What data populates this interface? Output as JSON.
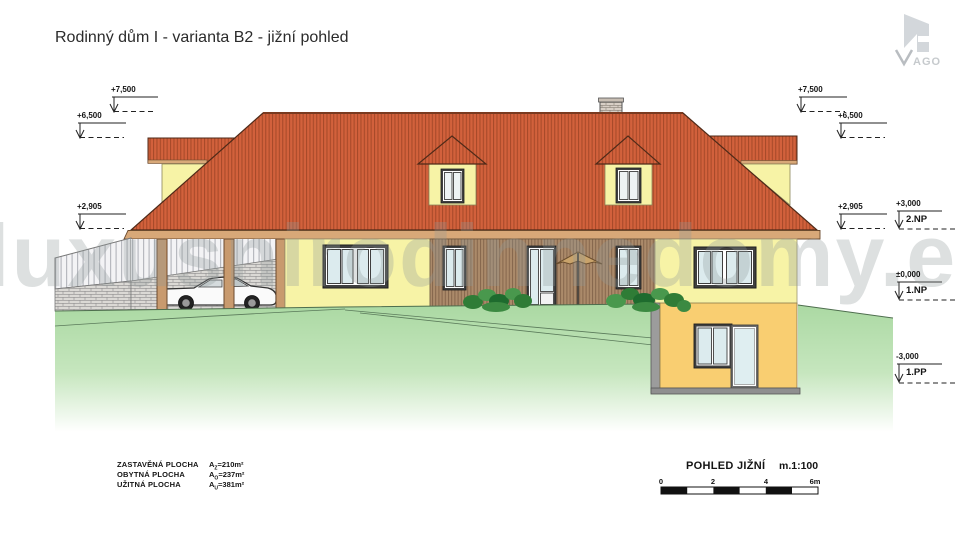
{
  "title": "Rodinný dům I - varianta B2 - jižní pohled",
  "watermark": "luxusnirodinnedomy.eu",
  "logo": {
    "v": "V",
    "text": "AGO"
  },
  "markers": {
    "left": [
      "+7,500",
      "+6,500",
      "+2,905"
    ],
    "right": [
      "+7,500",
      "+6,500",
      "+2,905"
    ],
    "floors": [
      {
        "value": "+3,000",
        "label": "2.NP"
      },
      {
        "value": "±0,000",
        "label": "1.NP"
      },
      {
        "value": "-3,000",
        "label": "1.PP"
      }
    ]
  },
  "areas": {
    "rows": [
      {
        "label": "ZASTAVĚNÁ PLOCHA",
        "sym": "A",
        "sub": "Z",
        "value": "=210m²"
      },
      {
        "label": "OBYTNÁ  PLOCHA",
        "sym": "A",
        "sub": "O",
        "value": "=237m²"
      },
      {
        "label": "UŽITNÁ  PLOCHA",
        "sym": "A",
        "sub": "U",
        "value": "=381m²"
      }
    ]
  },
  "view": {
    "title": "POHLED JIŽNÍ",
    "scale": "m.1:100"
  },
  "scalebar": {
    "ticks": [
      "0",
      "2",
      "4",
      "6m"
    ]
  },
  "colors": {
    "roof": "#d2613c",
    "roof_stripe": "#a84a2a",
    "wall": "#f7f3a6",
    "basement_wall": "#f9ce71",
    "wood": "#ab8a6a",
    "fascia": "#d8a878",
    "grass": "#a9d8a1",
    "glass": "#dcebee",
    "frame": "#3f3f3f"
  }
}
